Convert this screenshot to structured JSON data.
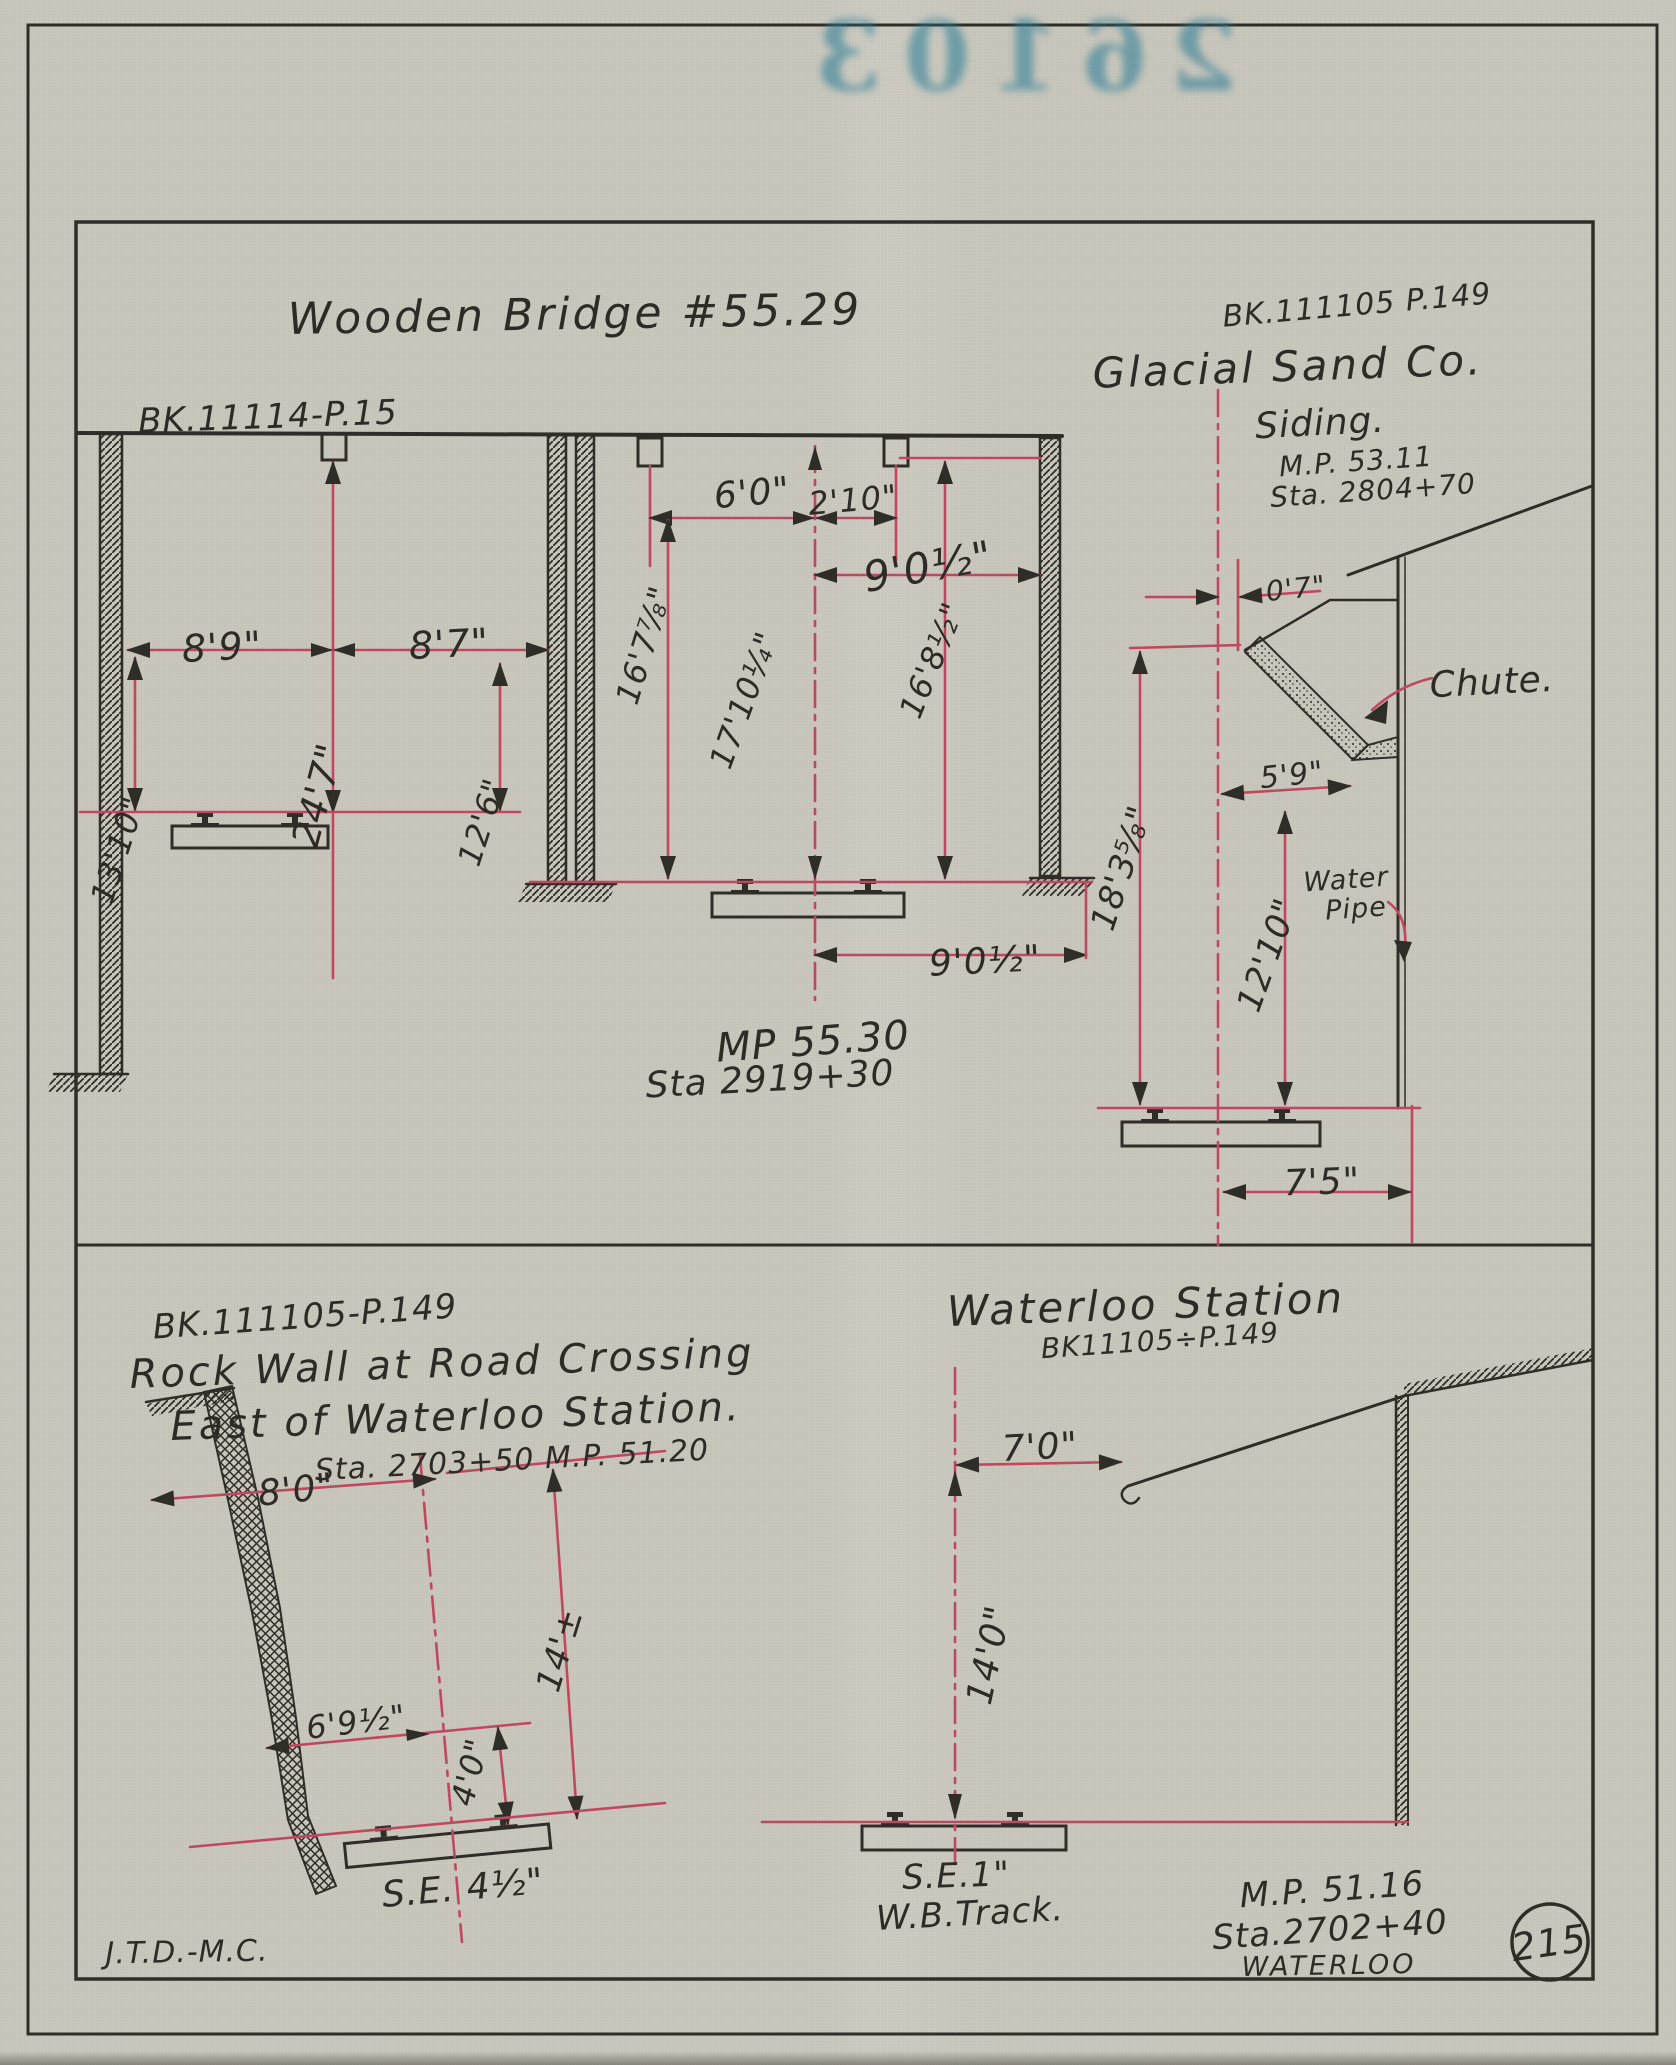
{
  "stamp": {
    "number": "26103"
  },
  "sheet": {
    "initials": "J.T.D.-M.C.",
    "page_badge": "215"
  },
  "bridge": {
    "title": "Wooden Bridge #55.29",
    "book_ref": "BK.11114-P.15",
    "mp": "MP 55.30",
    "sta": "Sta 2919+30",
    "dims": {
      "left_clearance": "8'9\"",
      "right_clearance": "8'7\"",
      "span_width": "24'7\"",
      "left_height": "13'10\"",
      "right_height": "12'6\"",
      "panel_left": "6'0\"",
      "panel_right": "2'10\"",
      "top_offset": "9'0½\"",
      "height_left": "16'7⅞\"",
      "height_center": "17'10¼\"",
      "height_right": "16'8½\"",
      "gauge_offset": "9'0½\""
    }
  },
  "glacial": {
    "book_ref": "BK.111105 P.149",
    "title": "Glacial Sand Co.",
    "subtitle": "Siding.",
    "mp": "M.P. 53.11",
    "sta": "Sta. 2804+70",
    "chute_label": "Chute.",
    "water_pipe_line1": "Water",
    "water_pipe_line2": "Pipe",
    "dims": {
      "offset": "0'7\"",
      "chute_clearance": "5'9\"",
      "height": "18'3⅝\"",
      "pipe_height": "12'10\"",
      "wall_offset": "7'5\""
    }
  },
  "rock_wall": {
    "book_ref": "BK.111105-P.149",
    "title_line1": "Rock Wall at Road Crossing",
    "title_line2": "East of Waterloo Station.",
    "sta_mp": "Sta. 2703+50 M.P. 51.20",
    "superelevation": "S.E. 4½\"",
    "dims": {
      "top_clearance": "8'0\"",
      "lower_clearance": "6'9½\"",
      "height_low": "4'0\"",
      "height": "14'±"
    }
  },
  "waterloo": {
    "title": "Waterloo Station",
    "book_ref": "BK11105÷P.149",
    "superelevation_line1": "S.E.1\"",
    "superelevation_line2": "W.B.Track.",
    "mp": "M.P. 51.16",
    "sta": "Sta.2702+40",
    "station_name": "WATERLOO",
    "dims": {
      "eave_offset": "7'0\"",
      "eave_height": "14'0\""
    }
  }
}
